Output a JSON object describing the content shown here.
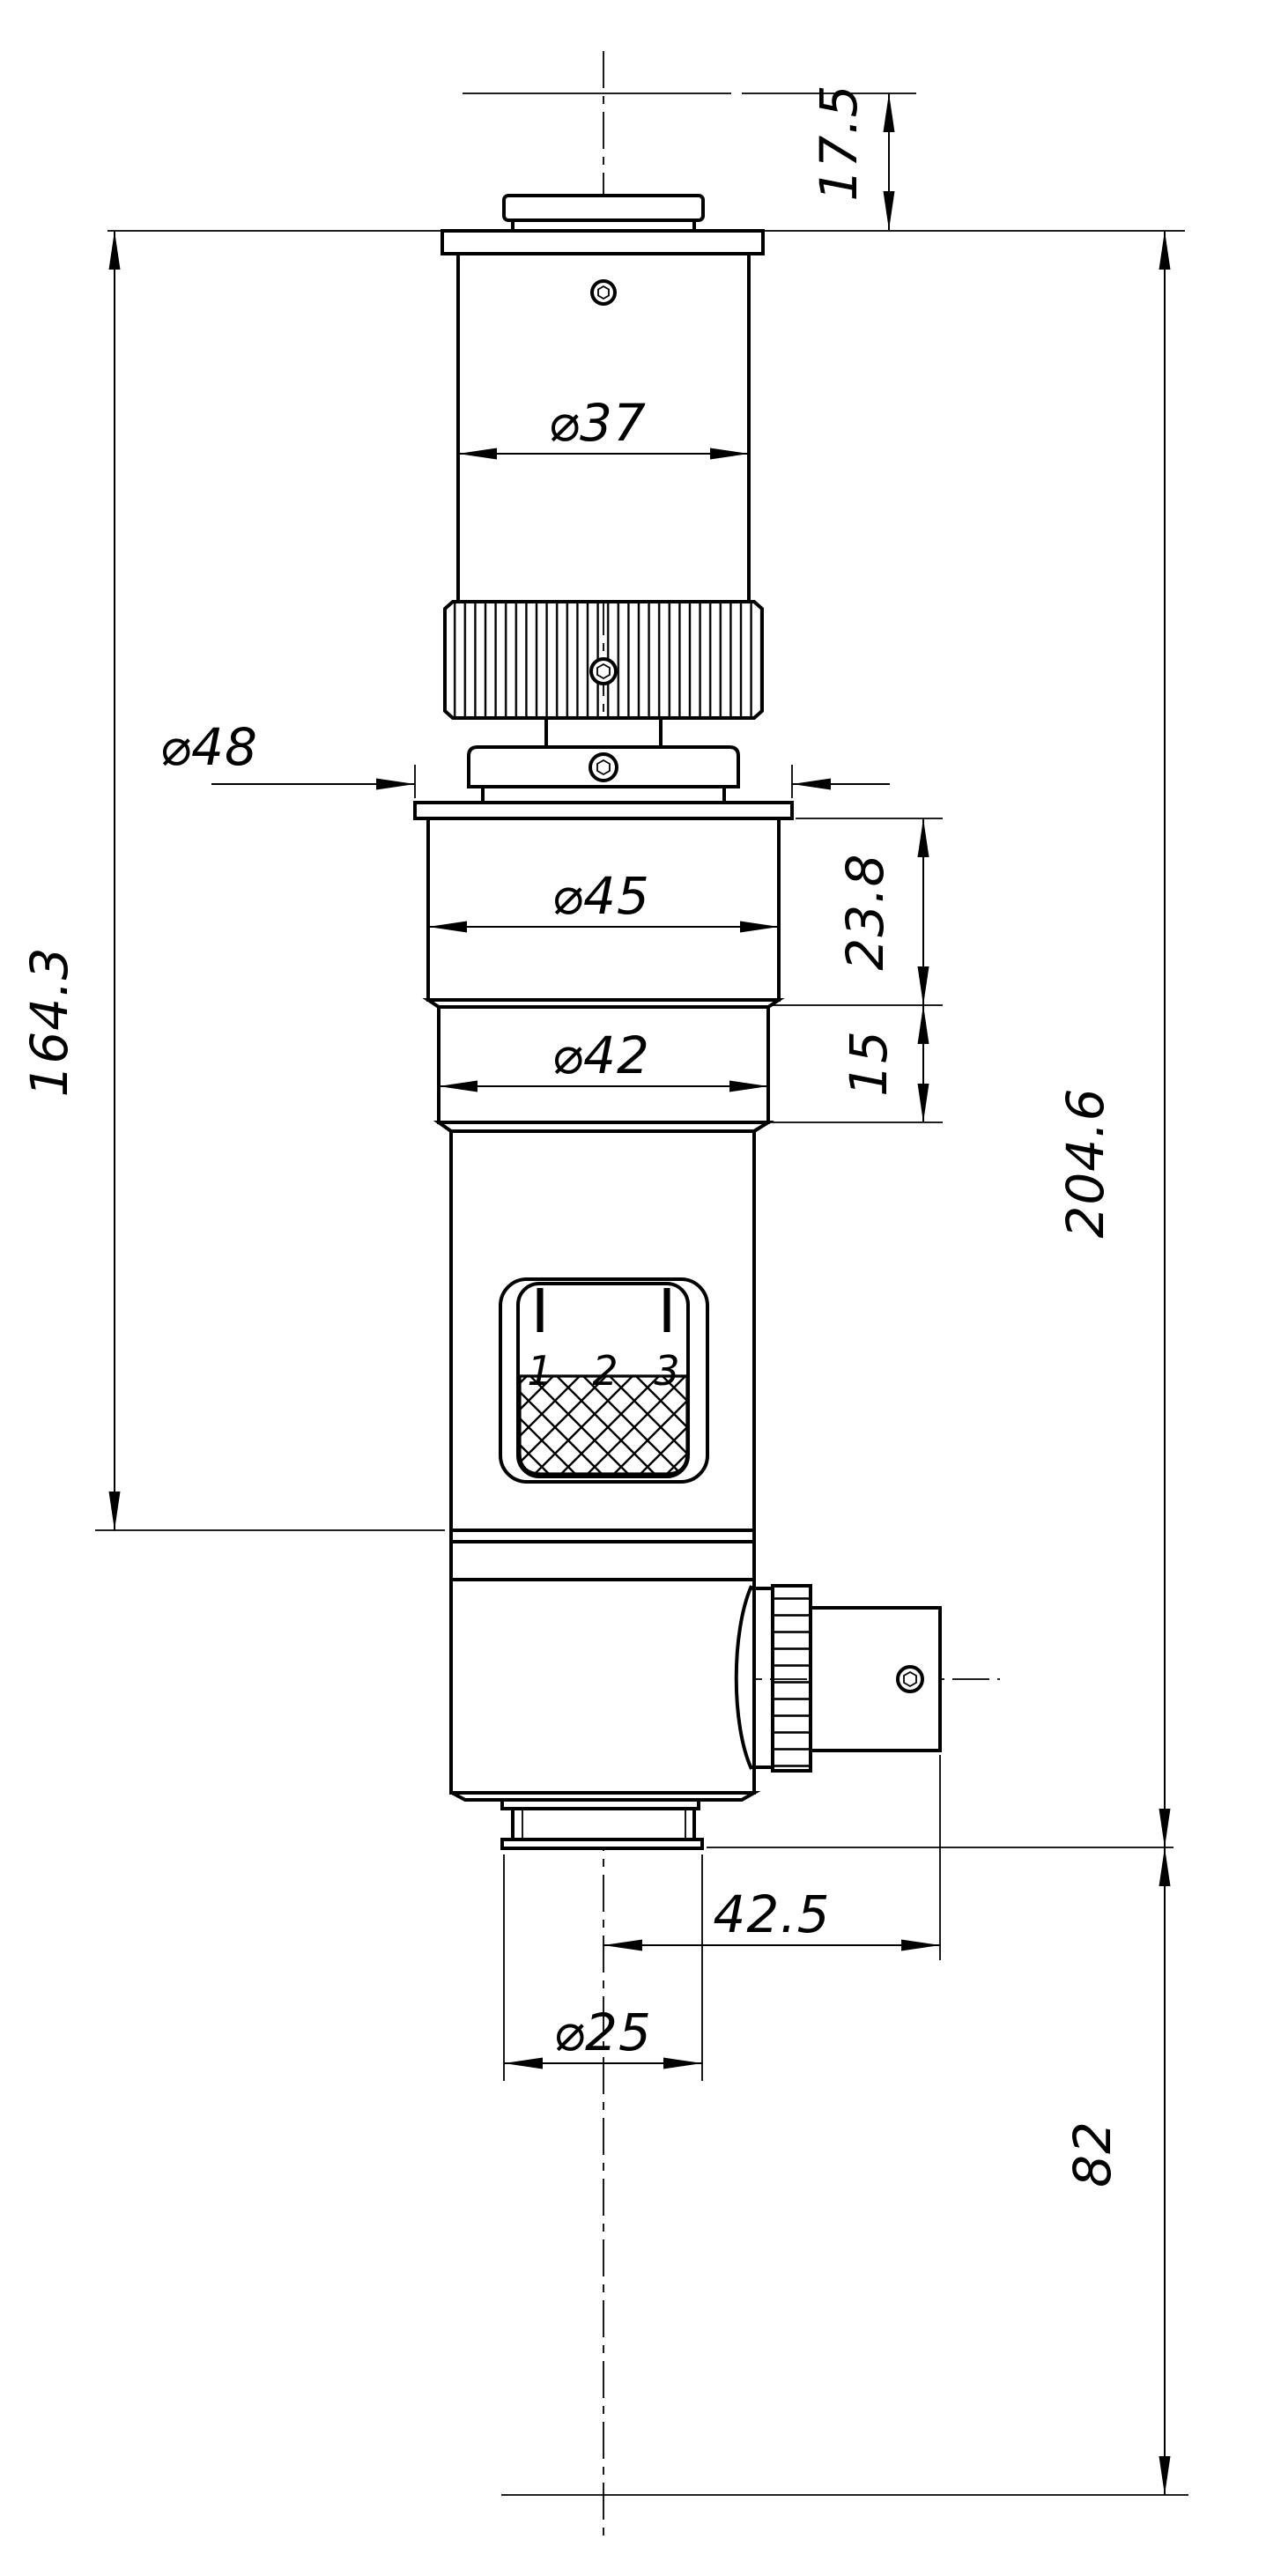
{
  "drawing": {
    "background_color": "#ffffff",
    "line_color": "#000000",
    "dim_labels": {
      "dia37": "⌀37",
      "dia48": "⌀48",
      "dia45": "⌀45",
      "dia42": "⌀42",
      "dia25": "⌀25",
      "height_17_5": "17.5",
      "height_164_3": "164.3",
      "height_204_6": "204.6",
      "height_23_8": "23.8",
      "height_15": "15",
      "width_42_5": "42.5",
      "height_82": "82"
    },
    "magnification_window": {
      "tick_labels": [
        "1",
        "2",
        "3"
      ]
    }
  }
}
